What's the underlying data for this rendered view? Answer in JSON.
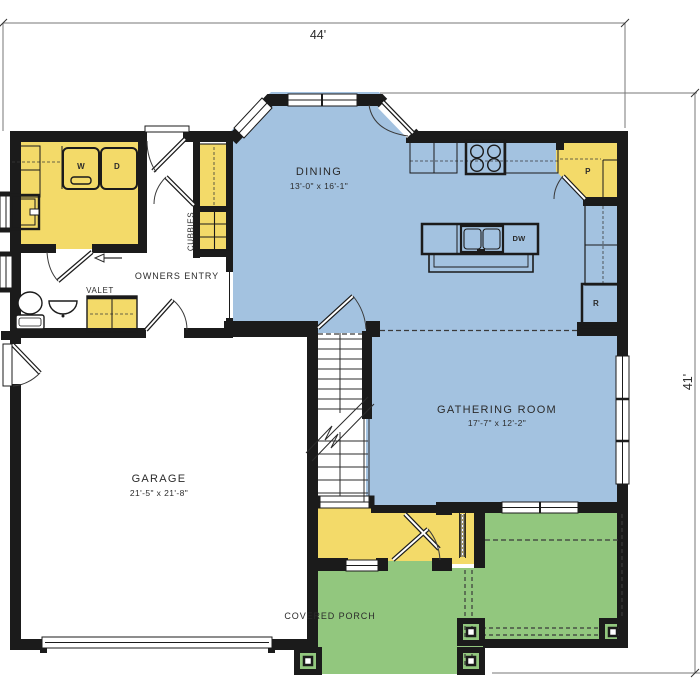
{
  "dimensions": {
    "width_label": "44'",
    "height_label": "41'"
  },
  "rooms": {
    "dining": {
      "label": "DINING",
      "size": "13'-0\" x 16'-1\""
    },
    "gathering": {
      "label": "GATHERING ROOM",
      "size": "17'-7\" x 12'-2\""
    },
    "garage": {
      "label": "GARAGE",
      "size": "21'-5\" x 21'-8\""
    },
    "covered_porch": {
      "label": "COVERED PORCH"
    },
    "owners_entry": {
      "label": "OWNERS ENTRY"
    },
    "valet": {
      "label": "VALET"
    },
    "cubbies": {
      "label": "CUBBIES"
    }
  },
  "appliances": {
    "washer": "W",
    "dryer": "D",
    "pantry": "P",
    "dishwasher": "DW",
    "refrigerator": "R"
  },
  "colors": {
    "living_space_blue": "#a3c2e0",
    "cabinetry_yellow": "#f3da69",
    "porch_green": "#92c77e",
    "wall_black": "#1b1b1b"
  }
}
